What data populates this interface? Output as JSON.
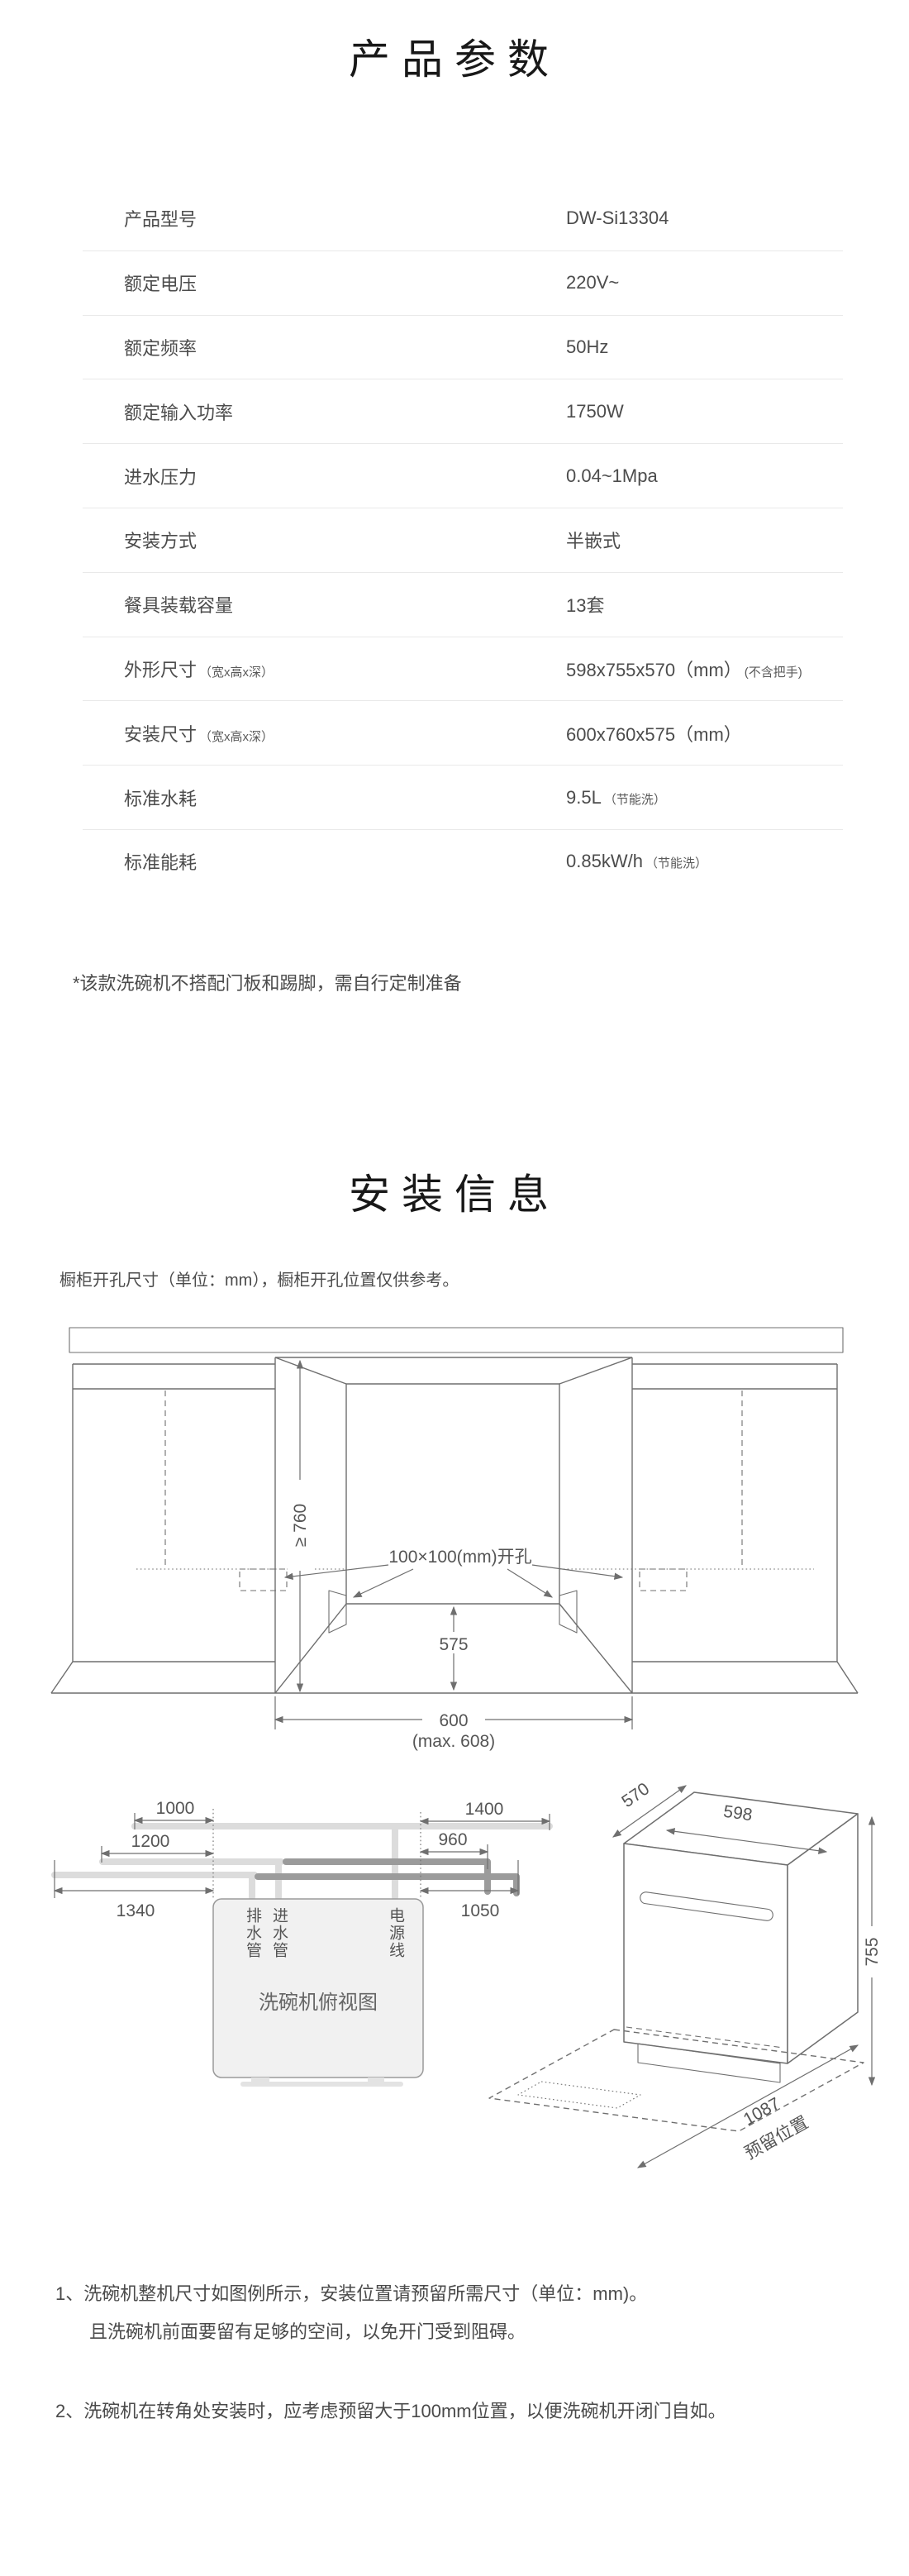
{
  "specs": {
    "title": "产品参数",
    "rows": [
      {
        "label": "产品型号",
        "value": "DW-Si13304"
      },
      {
        "label": "额定电压",
        "value": "220V~"
      },
      {
        "label": "额定频率",
        "value": "50Hz"
      },
      {
        "label": "额定输入功率",
        "value": "1750W"
      },
      {
        "label": "进水压力",
        "value": "0.04~1Mpa"
      },
      {
        "label": "安装方式",
        "value": "半嵌式"
      },
      {
        "label": "餐具装载容量",
        "value": "13套"
      },
      {
        "label": "外形尺寸",
        "label_note": "（宽x高x深）",
        "value": "598x755x570（mm）",
        "value_note": "(不含把手)"
      },
      {
        "label": "安装尺寸",
        "label_note": "（宽x高x深）",
        "value": "600x760x575（mm）"
      },
      {
        "label": "标准水耗",
        "value": "9.5L",
        "value_note": "（节能洗）"
      },
      {
        "label": "标准能耗",
        "value": "0.85kW/h",
        "value_note": "（节能洗）"
      }
    ],
    "footnote": "*该款洗碗机不搭配门板和踢脚，需自行定制准备"
  },
  "install": {
    "title": "安装信息",
    "subtitle": "橱柜开孔尺寸（单位：mm），橱柜开孔位置仅供参考。",
    "cabinet": {
      "height": "≥ 760",
      "hole": "100×100(mm)开孔",
      "depth": "575",
      "width": "600",
      "width_max": "(max. 608)"
    },
    "topview": {
      "title": "洗碗机俯视图",
      "labels": {
        "drain": "排水管",
        "inlet": "进水管",
        "power": "电源线"
      },
      "dims": {
        "power_left": "1000",
        "inlet_left": "1200",
        "drain_left": "1340",
        "power_right": "1400",
        "inlet_right": "960",
        "drain_right": "1050"
      }
    },
    "machine": {
      "depth": "570",
      "width": "598",
      "height": "755",
      "clearance": "1087",
      "clearance_sub": "预留位置"
    },
    "notes": {
      "n1": {
        "num": "1、",
        "line1": "洗碗机整机尺寸如图例所示，安装位置请预留所需尺寸（单位：mm)。",
        "line2": "且洗碗机前面要留有足够的空间，以免开门受到阻碍。"
      },
      "n2": {
        "num": "2、",
        "line1": "洗碗机在转角处安装时，应考虑预留大于100mm位置，以便洗碗机开闭门自如。"
      }
    }
  }
}
